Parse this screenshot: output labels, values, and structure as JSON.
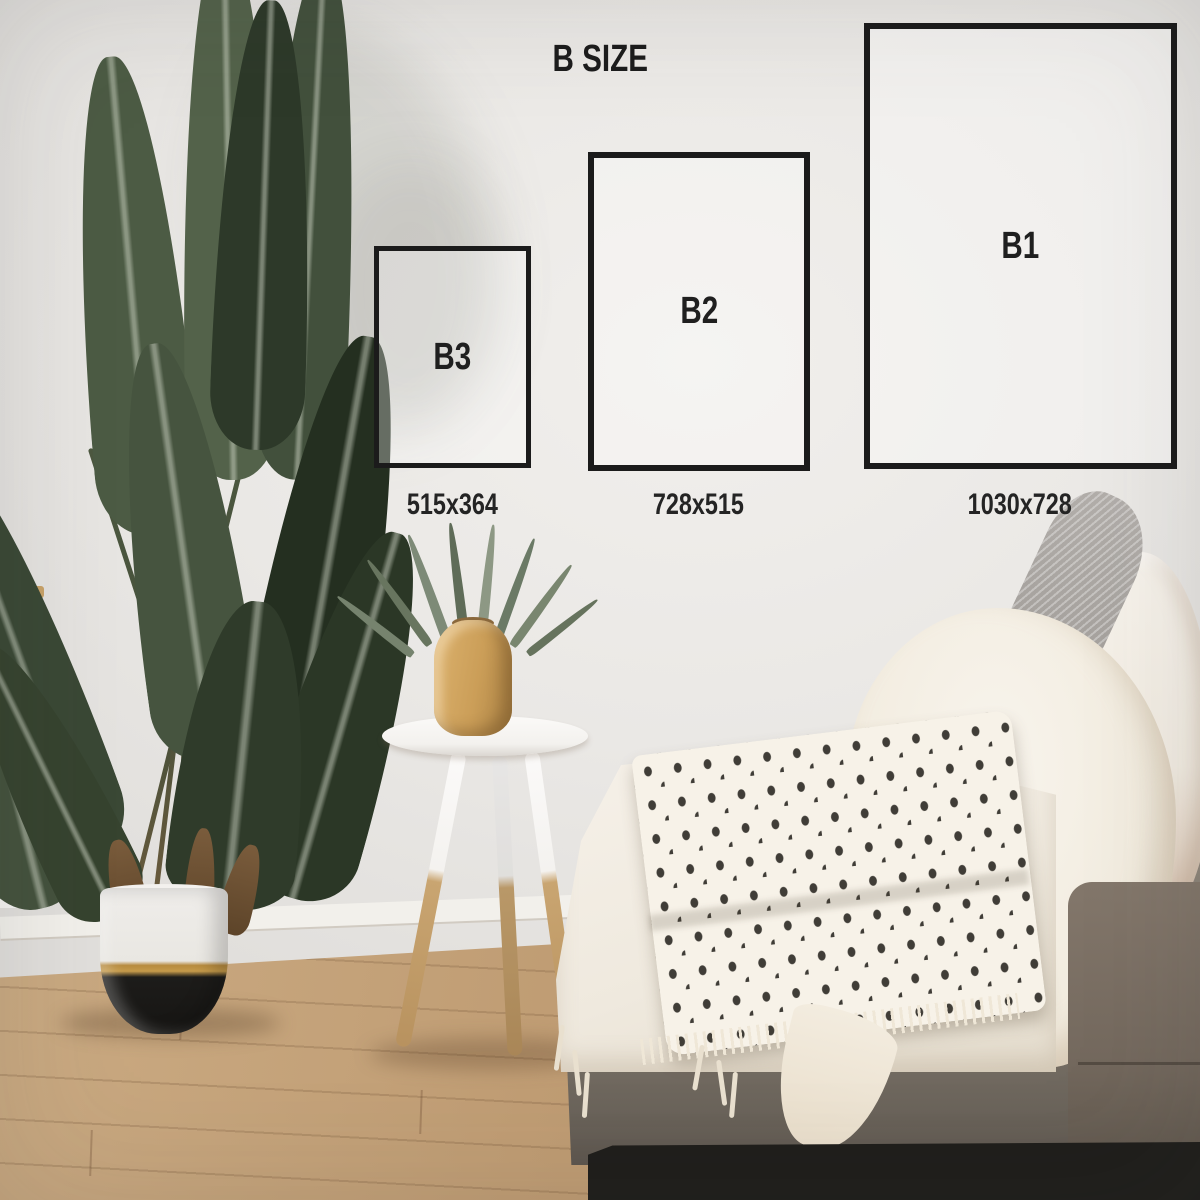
{
  "overlay": {
    "title": "B SIZE",
    "sizes": [
      {
        "label": "B3",
        "dimensions": "515x364"
      },
      {
        "label": "B2",
        "dimensions": "728x515"
      },
      {
        "label": "B1",
        "dimensions": "1030x728"
      }
    ],
    "frame_color": "#1b1b1b",
    "text_color": "#1f1f1f"
  },
  "scene": {
    "description": "bright living room wall used as backdrop for poster size comparison",
    "colors": {
      "wall": "#eae8e5",
      "floor_wood": "#c2a37c",
      "plant_leaf_dark": "#2c3827",
      "plant_leaf_light": "#55644a",
      "pot_white": "#edebe6",
      "pot_gold": "#b4883f",
      "pot_black": "#1b1a18",
      "table_white": "#f7f6f4",
      "table_leg_wood": "#c2a06e",
      "vase_wood": "#cda05c",
      "couch_fabric": "#7c746a",
      "couch_base": "#1f1e1c",
      "blanket_cream": "#f3eee5",
      "throw_pattern_dot": "#403d37",
      "pillow_knit": "#a6a29e",
      "pillow_sherpa": "#f5f1ea"
    }
  }
}
